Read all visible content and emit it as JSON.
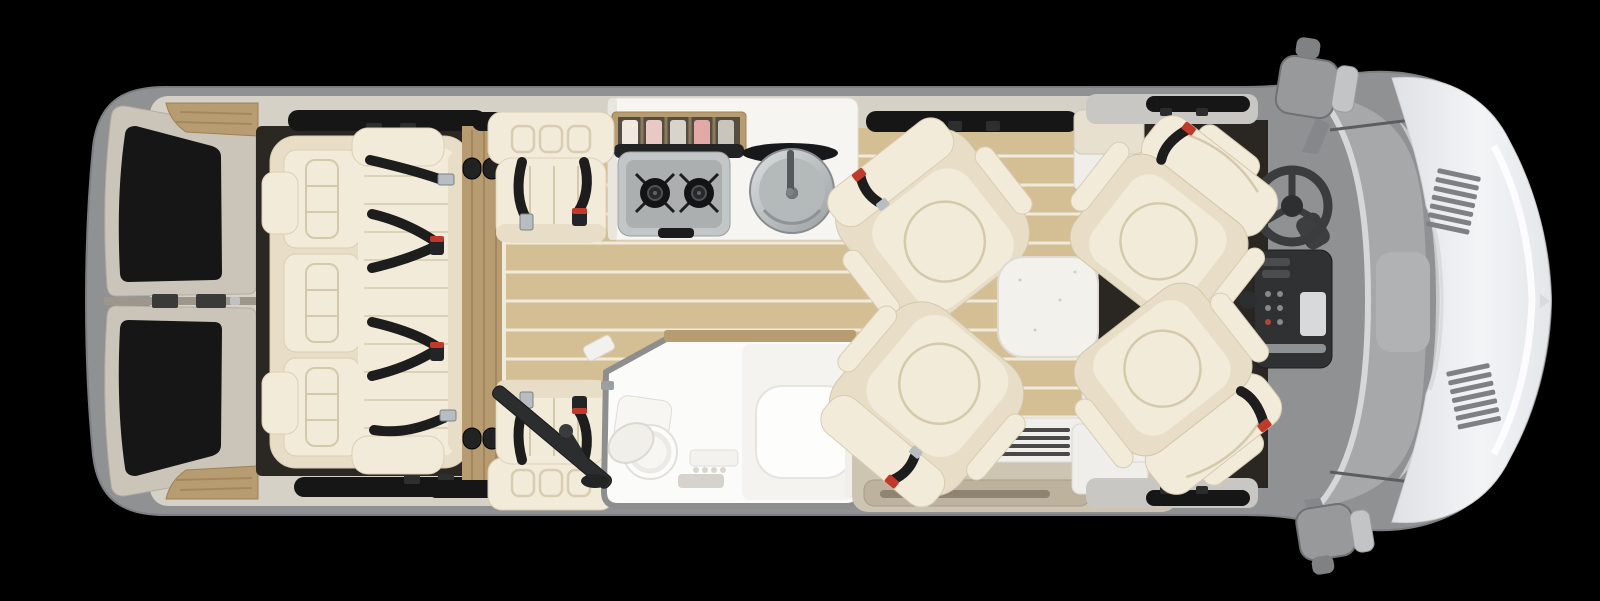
{
  "meta": {
    "scene": "rv-class-b-motorhome-floorplan-top-view",
    "canvas": {
      "width": 1600,
      "height": 601
    },
    "orientation": "rear-left-front-right"
  },
  "palette": {
    "bg": "#000000",
    "body": "#8f9193",
    "body_edge": "#74767a",
    "trim": "#d6d1c7",
    "door_panel": "#cbc5b9",
    "glass": "#161617",
    "dark_floor": "#2b2824",
    "carpet": "#2a2723",
    "wood": "#d4be94",
    "wood_gap": "#f0eadb",
    "wood_trim": "#b79b71",
    "wood_trim_dark": "#97794f",
    "cream": "#f2ebd9",
    "cream_mid": "#e8dec7",
    "cream_line": "#d5c9ac",
    "belt": "#1d1d1e",
    "buckle_silver": "#b8bdc1",
    "buckle_red": "#c0392b",
    "counter": "#f6f5f1",
    "steel": "#c2c6c7",
    "steel_dark": "#8e9395",
    "burner": "#131415",
    "bath_white": "#fbfbfa",
    "bath_border": "#8e8e8e",
    "table": "#f2f1eb",
    "step": "#cdc4b2",
    "step_tread": "#bdb29e",
    "vent_slat": "#4a4947",
    "partition": "#efeeea",
    "glass_gray": "#a6a8aa",
    "dash": "#c5c7c9",
    "dash_dark": "#b0b2b4",
    "console": "#2f3133",
    "hood": "#eff1f3",
    "vent_gray": "#7e8183",
    "wheel": "#3a3c3e",
    "mirror": "#97999b"
  },
  "components": {
    "rear_doors": "rear-doors-with-windows",
    "rear_sofa": "rear-sofa-with-seatbelts",
    "wood_floor": "plank-wood-floor",
    "galley": "kitchen-counter",
    "cooktop": "two-burner-stove",
    "sink": "round-stainless-sink-with-lid",
    "spice_rack": "overhead-storage-rack",
    "jump_seat_top": "forward-bench-seat-roadside",
    "jump_seat_bottom": "forward-bench-seat-curbside",
    "pedestal": "folding-table-pedestal",
    "bathroom": "wet-bath-with-toilet-and-shower-bench",
    "swivel_chairs": "two-lounge-swivel-chairs",
    "table": "removable-cocktail-table",
    "step_well": "sliding-door-step-well",
    "vent": "louvered-vent-panel",
    "cab_seats": "swiveled-driver-and-passenger-seats",
    "steering_wheel": "steering-wheel",
    "console": "center-console",
    "windshield": "windshield-and-dashboard",
    "hood": "front-hood",
    "mirrors": "two-exterior-mirrors"
  }
}
